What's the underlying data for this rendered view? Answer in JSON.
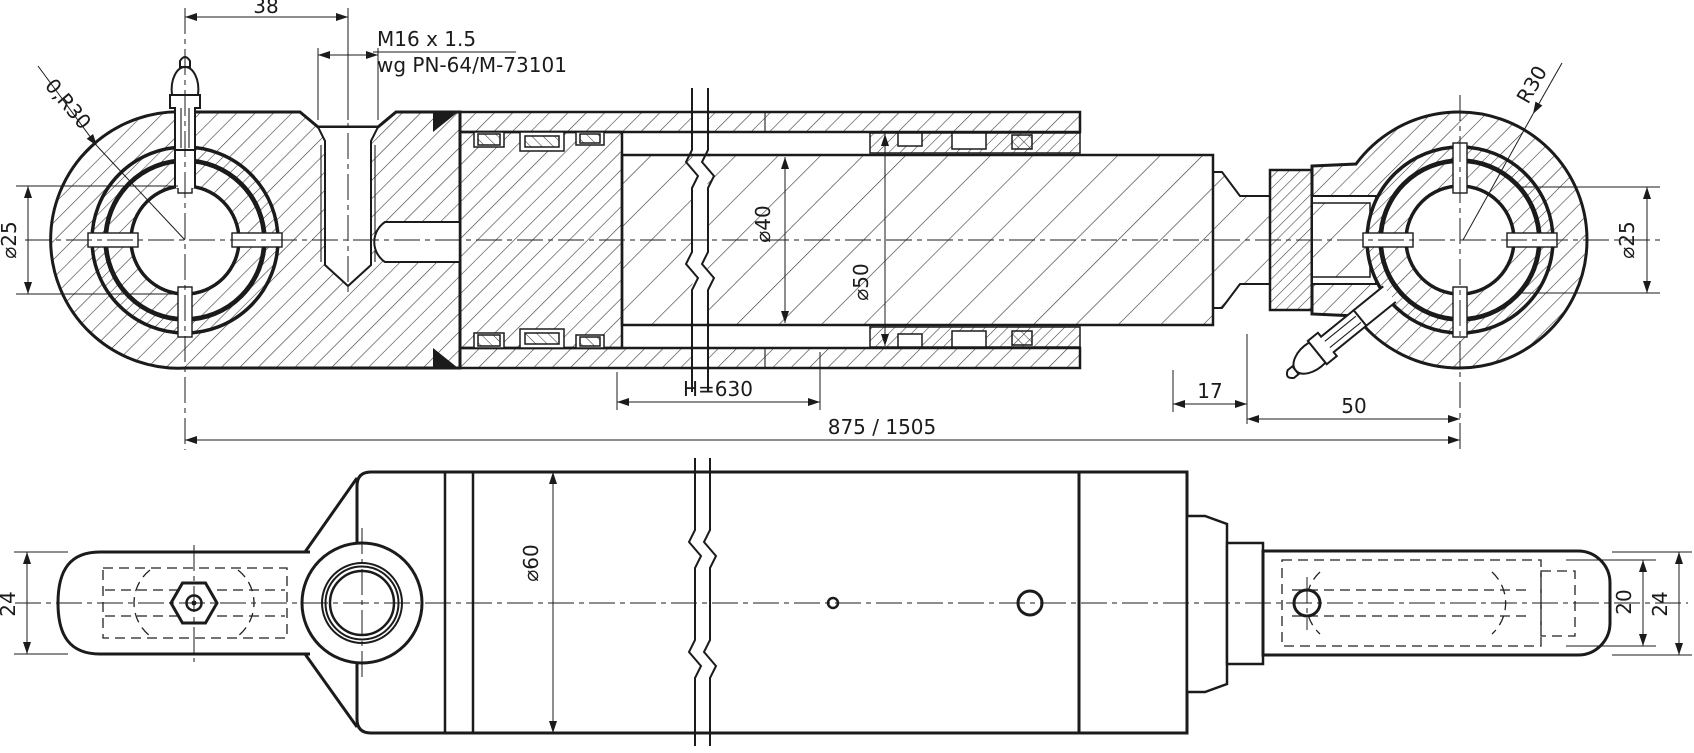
{
  "top_view": {
    "dim_38": "38",
    "port_thread_note_line1": "M16 x 1.5",
    "port_thread_note_line2": "wg PN-64/M-73101",
    "radius_note_left": "0,R30",
    "radius_note_right": "R30",
    "pin_bore_dia_left": "⌀25",
    "pin_bore_dia_right": "⌀25",
    "rod_dia": "⌀40",
    "bore_dia": "⌀50",
    "stroke_dim": "H=630",
    "gland_dim": "17",
    "rod_end_dim": "50",
    "overall_length": "875 / 1505"
  },
  "bottom_view": {
    "eye_thickness_left": "24",
    "barrel_dia": "⌀60",
    "clevis_inner_width": "20",
    "eye_thickness_right": "24"
  },
  "colors": {
    "line": "#1b1b1b",
    "background": "#ffffff",
    "hatch": "#3a3a3a"
  }
}
